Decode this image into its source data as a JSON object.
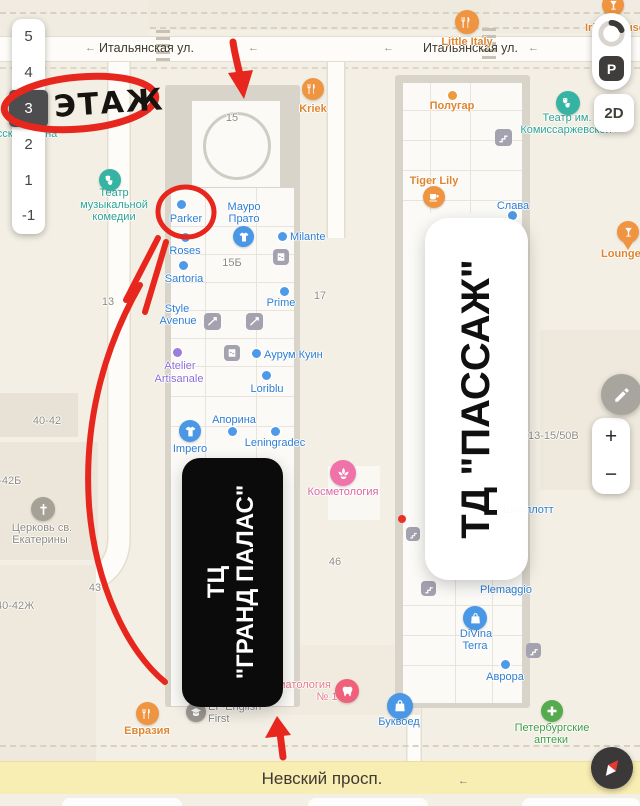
{
  "floor_selector": {
    "floors": [
      "5",
      "4",
      "3",
      "2",
      "1",
      "-1"
    ],
    "selected": "3"
  },
  "controls": {
    "parking": "P",
    "mode_2d": "2D",
    "zoom_in": "+",
    "zoom_out": "−"
  },
  "annotation": {
    "etazh": "ЭТАЖ"
  },
  "overlay": {
    "grand_line1": "ТЦ",
    "grand_line2": "\"ГРАНД ПАЛАС\"",
    "passage": "ТД \"ПАССАЖ\""
  },
  "streets": {
    "ital_left": "Итальянская ул.",
    "ital_right": "Итальянская ул.",
    "nevsky": "Невский просп."
  },
  "buildings": {
    "n15": "15",
    "n15b": "15Б",
    "n17": "17",
    "n13": "13",
    "n46": "46",
    "n43": "43",
    "n40_42": "40-42",
    "n40_42b": "40-42Б",
    "n40_42zh": "40-42Ж",
    "n13_15_50v": "13-15/50В"
  },
  "places": {
    "little_italy": "Little Italy",
    "irish_house": "Irish House",
    "kriek": "Kriek",
    "polugar": "Полугар",
    "teatr_kom1": "Театр им.",
    "teatr_kom2": "Комиссаржевской",
    "tiger_lily": "Tiger Lily",
    "slava": "Слава",
    "lounger": "LoungeR",
    "teatr_muz1": "Театр",
    "teatr_muz2": "музыкальной",
    "teatr_muz3": "комедии",
    "ruskaya_ikona": "Русская икона",
    "parker": "Parker",
    "mauro1": "Мауро",
    "mauro2": "Прато",
    "milante": "Milante",
    "roses": "Roses",
    "sartoria": "Sartoria",
    "prime": "Prime",
    "style1": "Style",
    "style2": "Avenue",
    "aurum": "Аурум Куин",
    "atelier1": "Atelier",
    "atelier2": "Artisanale",
    "loriblu": "Loriblu",
    "aporina": "Апорина",
    "impero": "Impero",
    "leningradec": "Leningradec",
    "kosmetologia": "Косметология",
    "shonplott": "Шонплотт",
    "plemaggio": "Plemaggio",
    "divina1": "DiVina",
    "divina2": "Terra",
    "avrora": "Аврора",
    "bukvoed": "Буквоед",
    "stomat1": "Стоматология",
    "stomat2": "№ 1",
    "ef1": "EF English",
    "ef2": "First",
    "evrazia": "Евразия",
    "apteki1": "Петербургские",
    "apteki2": "аптеки",
    "church1": "Церковь св.",
    "church2": "Екатерины"
  },
  "colors": {
    "annotation_red": "#e7261d",
    "label_blue": "#2d7dd2",
    "label_orange": "#de8531",
    "road_yellow": "#f8edb2"
  }
}
